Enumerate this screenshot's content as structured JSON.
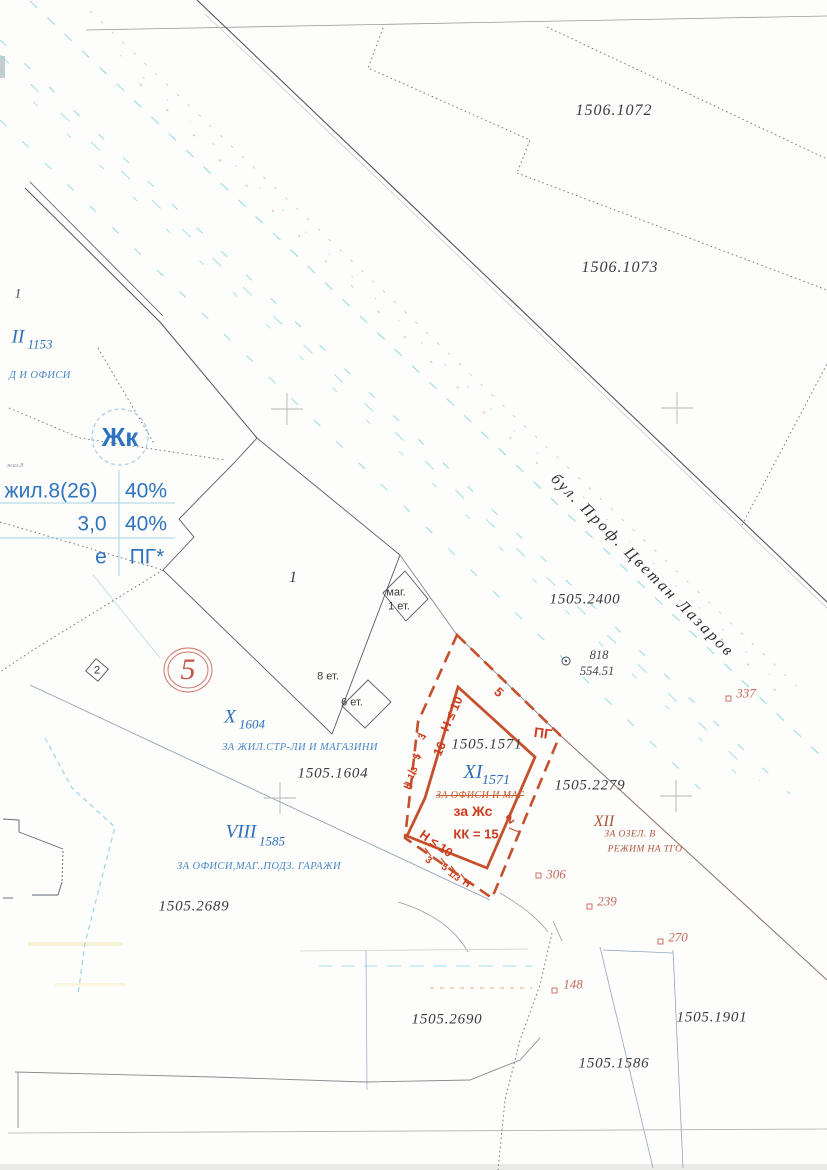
{
  "street": {
    "label": "бул. Проф. Цветан Лазаров"
  },
  "zone_badge": {
    "symbol": "Жк"
  },
  "plan_table": {
    "r1l": "жил.8(26)",
    "r1r": "40%",
    "r2l": "3,0",
    "r2r": "40%",
    "r3l": "е",
    "r3r": "ПГ*"
  },
  "parcels": {
    "p1506_1072": "1506.1072",
    "p1506_1073": "1506.1073",
    "p1505_2400": "1505.2400",
    "p1505_2279": "1505.2279",
    "p1505_1604": "1505.1604",
    "p1505_1571": "1505.1571",
    "p1505_2689": "1505.2689",
    "p1505_2690": "1505.2690",
    "p1505_1901": "1505.1901",
    "p1505_1586": "1505.1586"
  },
  "upi_xi": {
    "roman": "XI",
    "num": "1571",
    "old_use": "ЗА ОФИСИ И МАГ",
    "use": "за Жс",
    "kk": "КК = 15",
    "h10": "Н ≤ 10",
    "w16": "16",
    "d3": "3",
    "d5": "5",
    "d13": "1/3",
    "dh": "Н",
    "e5": "5",
    "e2": "2",
    "pg": "ПГ"
  },
  "upi_x": {
    "roman": "X",
    "num": "1604",
    "use": "ЗА ЖИЛ.СТР-ЛИ И МАГАЗИНИ"
  },
  "upi_viii": {
    "roman": "VIII",
    "num": "1585",
    "use": "ЗА ОФИСИ,МАГ.,ПОДЗ. ГАРАЖИ"
  },
  "upi_xii": {
    "roman": "XII",
    "use1": "ЗА ОЗЕЛ. В",
    "use2": "РЕЖИМ НА ТГО"
  },
  "upi_ii": {
    "roman": "II",
    "num": "1153",
    "use": "Д И ОФИСИ"
  },
  "blocks": {
    "b5": "5",
    "b2": "2",
    "b1": "1",
    "mag": "маг.",
    "mag_fl": "1 ет.",
    "fl8": "8 ет.",
    "fl6": "6 ет."
  },
  "points": {
    "p818": "818",
    "p818_z": "554.51",
    "p337": "337",
    "p306": "306",
    "p239": "239",
    "p270": "270",
    "p148": "148"
  },
  "corner": {
    "n1": "1",
    "tiny": "жил.8"
  },
  "colors": {
    "accent_red": "#c5502b",
    "blue": "#2e6fb8",
    "cyan_road": "#8fd7e8",
    "soft_red": "#c4685a"
  }
}
